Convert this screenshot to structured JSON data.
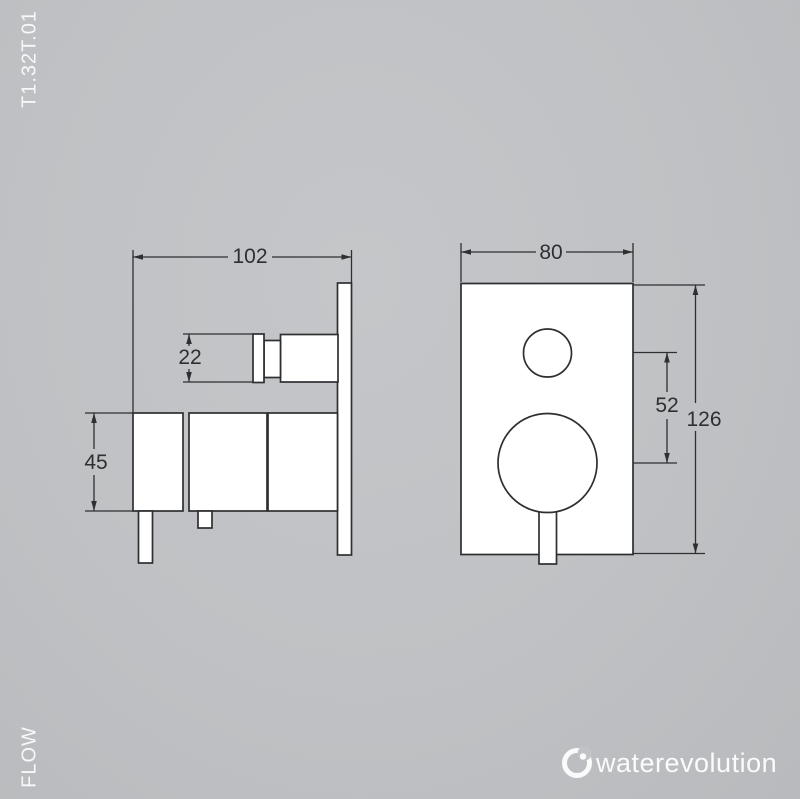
{
  "product_code": "T1.32T.01",
  "flow_label": "FLOW",
  "brand": {
    "name": "waterevolution",
    "icon": "water-drop-circle-icon"
  },
  "drawing": {
    "type": "technical-dimension-drawing",
    "views": [
      "side-view",
      "front-view"
    ],
    "dimensions": {
      "side_total_width": "102",
      "knob_diameter": "22",
      "body_height": "45",
      "plate_width": "80",
      "handle_center_spacing": "52",
      "plate_height": "126"
    }
  },
  "colors": {
    "background": "#bfc1c4",
    "line": "#2d2f31",
    "shape_fill": "#ffffff",
    "light_text": "#f7f8f8"
  }
}
